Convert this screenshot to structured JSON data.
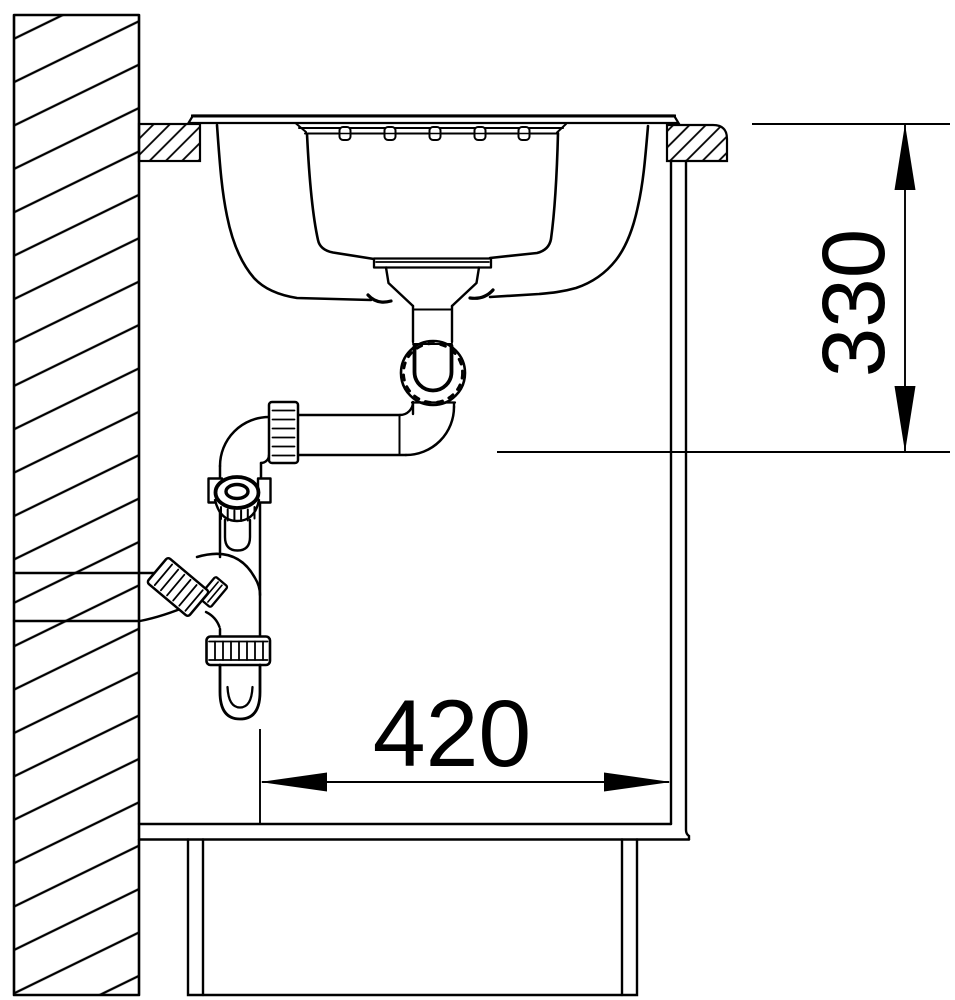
{
  "diagram": {
    "background": "#ffffff",
    "line_color": "#000000",
    "dimensions": {
      "vertical": {
        "value": "330"
      },
      "horizontal": {
        "value": "420"
      }
    },
    "components": [
      "wall",
      "worktop",
      "inset-sink-bowl",
      "drain-siphon-trap",
      "wall-drain-connection",
      "cabinet-side-panel",
      "cabinet-floor",
      "plinth"
    ]
  }
}
